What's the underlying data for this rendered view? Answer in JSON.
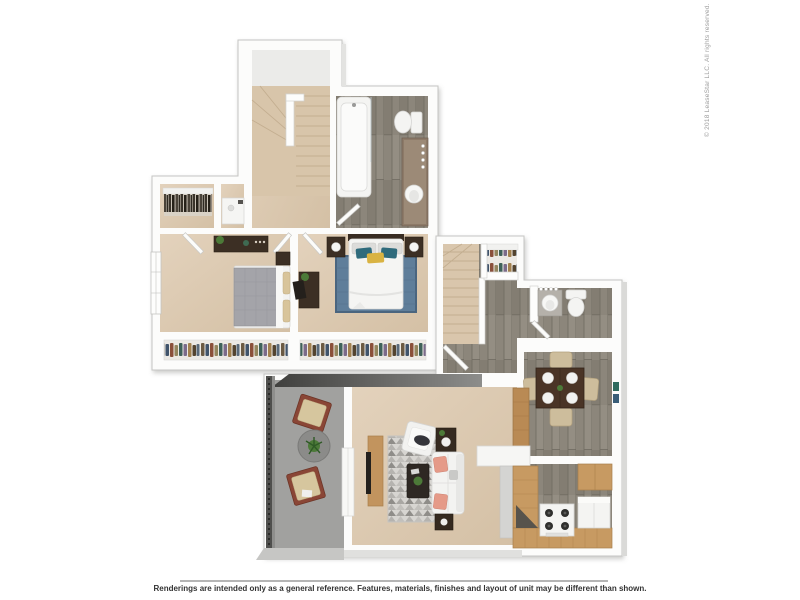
{
  "watermark": {
    "copyright": "© 2018 LeaseStar LLC. All rights reserved."
  },
  "footer": {
    "disclaimer": "Renderings are intended only as a general reference. Features, materials, finishes and layout of unit may be different than shown."
  },
  "palette": {
    "background": "#ffffff",
    "wall_white": "#fcfcfb",
    "wall_edge": "#c5c5c3",
    "carpet_beige": "#dccab2",
    "wood_floor_gray": "#8c867b",
    "patio_concrete": "#a1a19f",
    "roof_edge_dark": "#3f3f3d",
    "walkway_gray": "#c6c6c4",
    "counter_tan": "#c79a62",
    "furniture_dark_wood": "#3c2f24",
    "bedroom_rug_blue": "#5f7e9a",
    "living_rug_gray": "#d7d5d1",
    "accent_pillow_pink": "#e59a88",
    "accent_pillow_teal": "#2f6b7c",
    "accent_pillow_yellow": "#d9b342",
    "copyright_text_gray": "#9c9c9c",
    "disclaimer_text_dark": "#333333",
    "divider_gray": "#b5b5b5"
  }
}
